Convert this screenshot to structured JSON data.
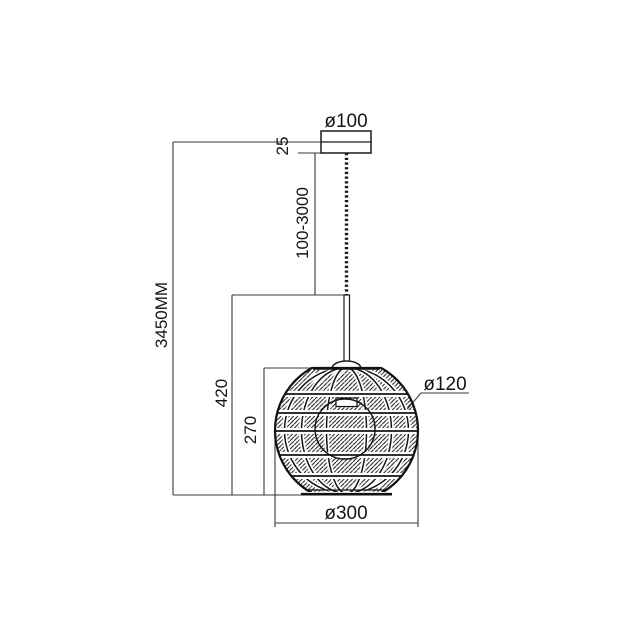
{
  "page": {
    "background": "#ffffff",
    "line_color": "#1b1b1b",
    "dim_line_color": "#3a3a3a"
  },
  "drawing": {
    "dimensions": {
      "canopy_diameter": "ø100",
      "canopy_height": "25",
      "suspension_length": "100-3000",
      "total_height": "3450MM",
      "lower_section_height": "420",
      "shade_height": "270",
      "top_opening_diameter": "ø120",
      "shade_diameter": "ø300"
    }
  }
}
